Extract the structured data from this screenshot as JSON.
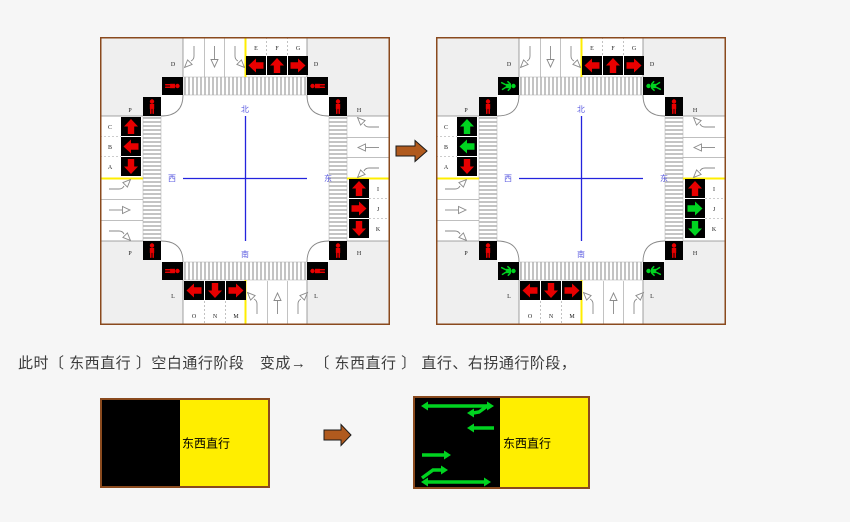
{
  "page": {
    "background": "#f6f6f6"
  },
  "caption": "此时〔 东西直行 〕空白通行阶段　变成→　〔 东西直行 〕 直行、右拐通行阶段，",
  "colors": {
    "signal_red": "#e80000",
    "signal_green": "#00d320",
    "lane_yellow": "#ffee00",
    "panel_yellow": "#ffee00",
    "diagram_border": "#8a4a1e",
    "transition_arrow": "#b05a1e",
    "cross_blue": "#2323dd",
    "compass_blue": "#5a5ae0",
    "crosswalk_gray": "#c4c4c4"
  },
  "compass": {
    "north": "北",
    "south": "南",
    "west": "西",
    "east": "东"
  },
  "diagrams": {
    "before": {
      "signals": {
        "north": [
          {
            "label": "E",
            "arrow": "left",
            "state": "red"
          },
          {
            "label": "F",
            "arrow": "up",
            "state": "red"
          },
          {
            "label": "G",
            "arrow": "right",
            "state": "red"
          }
        ],
        "west": [
          {
            "label": "C",
            "arrow": "up",
            "state": "red"
          },
          {
            "label": "B",
            "arrow": "left",
            "state": "red"
          },
          {
            "label": "A",
            "arrow": "down",
            "state": "red"
          }
        ],
        "east": [
          {
            "label": "I",
            "arrow": "up",
            "state": "red"
          },
          {
            "label": "J",
            "arrow": "right",
            "state": "red"
          },
          {
            "label": "K",
            "arrow": "down",
            "state": "red"
          }
        ],
        "south": [
          {
            "label": "O",
            "arrow": "left",
            "state": "red"
          },
          {
            "label": "N",
            "arrow": "down",
            "state": "red"
          },
          {
            "label": "M",
            "arrow": "right",
            "state": "red"
          }
        ]
      },
      "pedestrian_signals": {
        "north_crosswalk": "red",
        "south_crosswalk": "red",
        "west_crosswalk": "red",
        "east_crosswalk": "red"
      },
      "corner_letters": {
        "nw": "D",
        "ne": "D",
        "sw": "L",
        "se": "L",
        "wn": "P",
        "ws": "P",
        "en": "H",
        "es": "H"
      }
    },
    "after": {
      "signals": {
        "north": [
          {
            "label": "E",
            "arrow": "left",
            "state": "red"
          },
          {
            "label": "F",
            "arrow": "up",
            "state": "red"
          },
          {
            "label": "G",
            "arrow": "right",
            "state": "red"
          }
        ],
        "west": [
          {
            "label": "C",
            "arrow": "up",
            "state": "green"
          },
          {
            "label": "B",
            "arrow": "left",
            "state": "green"
          },
          {
            "label": "A",
            "arrow": "down",
            "state": "red"
          }
        ],
        "east": [
          {
            "label": "I",
            "arrow": "up",
            "state": "red"
          },
          {
            "label": "J",
            "arrow": "right",
            "state": "green"
          },
          {
            "label": "K",
            "arrow": "down",
            "state": "green"
          }
        ],
        "south": [
          {
            "label": "O",
            "arrow": "left",
            "state": "red"
          },
          {
            "label": "N",
            "arrow": "down",
            "state": "red"
          },
          {
            "label": "M",
            "arrow": "right",
            "state": "red"
          }
        ]
      },
      "pedestrian_signals": {
        "north_crosswalk": "green",
        "south_crosswalk": "green",
        "west_crosswalk": "red",
        "east_crosswalk": "red"
      },
      "corner_letters": {
        "nw": "D",
        "ne": "D",
        "sw": "L",
        "se": "L",
        "wn": "P",
        "ws": "P",
        "en": "H",
        "es": "H"
      }
    }
  },
  "phase_panels": {
    "before": {
      "label": "东西直行"
    },
    "after": {
      "label": "东西直行",
      "green_arrows": [
        {
          "type": "double",
          "x1": 6,
          "x2": 79,
          "y": 8
        },
        {
          "type": "hook-left",
          "x": 52,
          "y": 15,
          "tail": "M75,6 L64,14 L58,15"
        },
        {
          "type": "left",
          "x1": 79,
          "x2": 52,
          "y": 30
        },
        {
          "type": "right",
          "x1": 7,
          "x2": 36,
          "y": 57
        },
        {
          "type": "hook-right",
          "x": 33,
          "y": 72,
          "tail": "M7,80 L18,72 L27,72"
        },
        {
          "type": "double",
          "x1": 6,
          "x2": 76,
          "y": 84
        }
      ]
    }
  }
}
